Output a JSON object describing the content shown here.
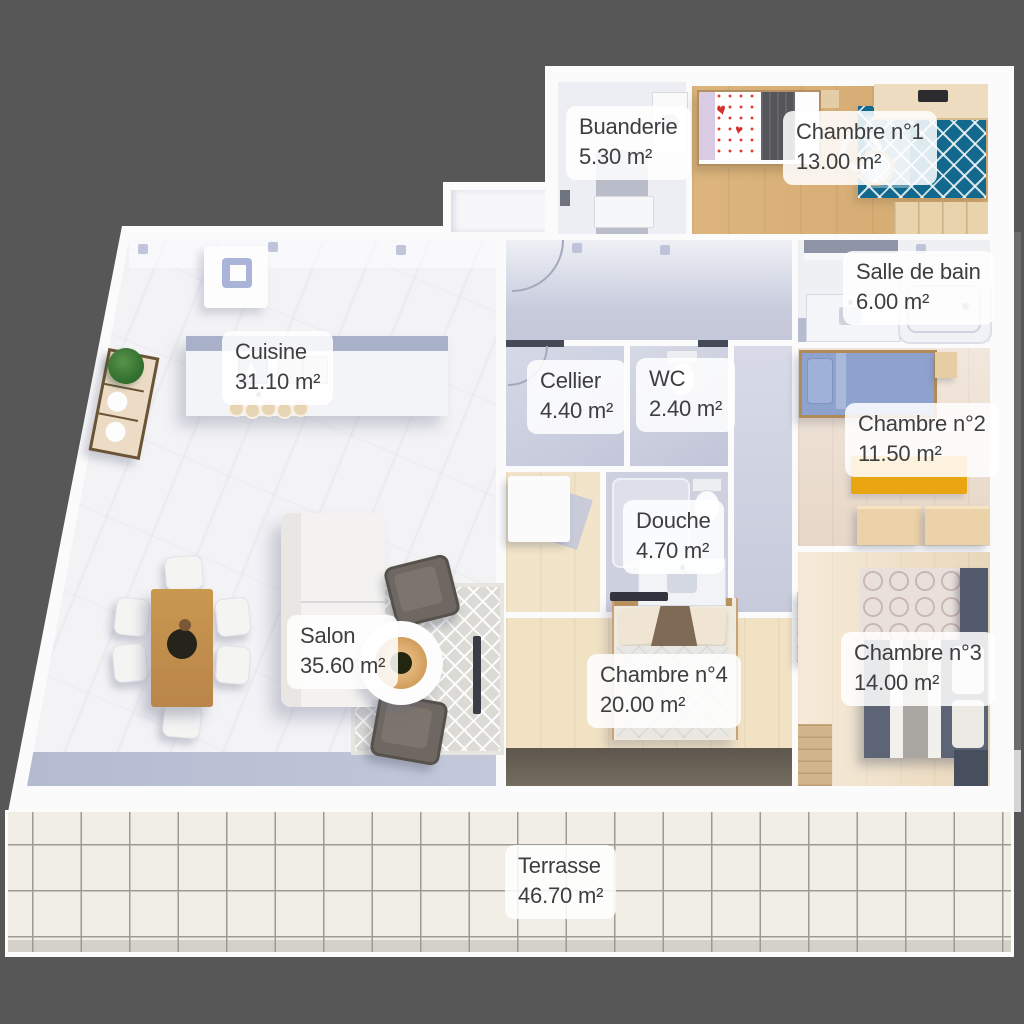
{
  "scene": {
    "type": "floor-plan",
    "view": "top-down-3d-render",
    "background_color": "#575757",
    "unit": "m²"
  },
  "rooms": [
    {
      "id": "buanderie",
      "name": "Buanderie",
      "area": "5.30 m²"
    },
    {
      "id": "chambre-1",
      "name": "Chambre n°1",
      "area": "13.00 m²"
    },
    {
      "id": "salle-de-bain",
      "name": "Salle de bain",
      "area": "6.00 m²"
    },
    {
      "id": "cuisine",
      "name": "Cuisine",
      "area": "31.10 m²"
    },
    {
      "id": "cellier",
      "name": "Cellier",
      "area": "4.40 m²"
    },
    {
      "id": "wc",
      "name": "WC",
      "area": "2.40 m²"
    },
    {
      "id": "chambre-2",
      "name": "Chambre n°2",
      "area": "11.50 m²"
    },
    {
      "id": "douche",
      "name": "Douche",
      "area": "4.70 m²"
    },
    {
      "id": "salon",
      "name": "Salon",
      "area": "35.60 m²"
    },
    {
      "id": "chambre-4",
      "name": "Chambre n°4",
      "area": "20.00 m²"
    },
    {
      "id": "chambre-3",
      "name": "Chambre n°3",
      "area": "14.00 m²"
    },
    {
      "id": "terrasse",
      "name": "Terrasse",
      "area": "46.70 m²"
    }
  ],
  "palette": {
    "background": "#575757",
    "walls": "#fbfbfc",
    "marble_floor": "#f3f3f6",
    "wet_room_floor": "#c9cdde",
    "wood_floor": "#eedcbc",
    "terrace_tile": "#f1eee6",
    "teal_rug": "#13688d",
    "yellow_rug": "#e9a512",
    "blue_bed": "#8da2cc",
    "label_text": "#3e3e40",
    "label_background": "rgba(255,255,255,0.86)"
  }
}
